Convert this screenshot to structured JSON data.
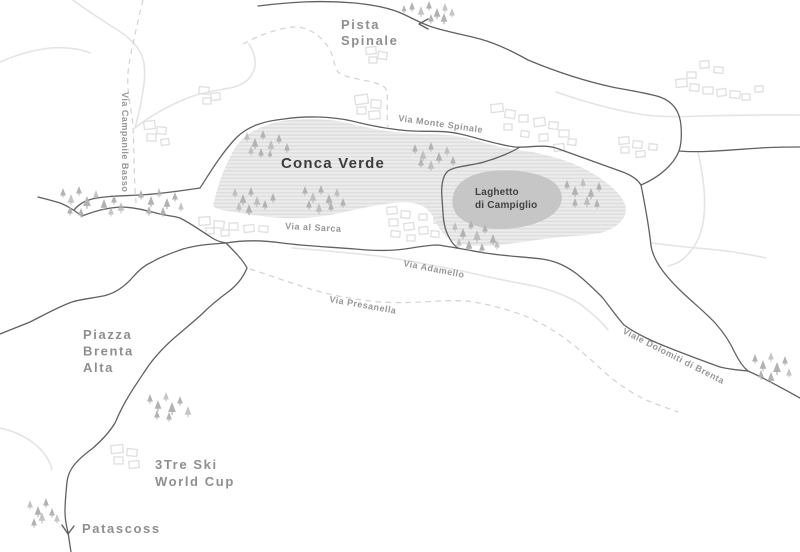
{
  "map": {
    "colors": {
      "background": "#ffffff",
      "road_dark": "#616161",
      "road_light": "#e4e4e4",
      "trail_dashed": "#d2d2d2",
      "terrain_stripe_base": "#ececec",
      "terrain_stripe_line": "#dedede",
      "lake_fill": "#c6c6c6",
      "tree_fill": "#b2b2b2",
      "building_stroke": "#dfdfdf",
      "label_dark": "#3d3d3d",
      "label_gray": "#8f8f8f",
      "label_road": "#979797"
    },
    "labels": [
      {
        "id": "pista-spinale",
        "lines": [
          "Pista",
          "Spinale"
        ],
        "x": 341,
        "y": 29,
        "lh": 16,
        "cls": "place"
      },
      {
        "id": "conca-verde",
        "lines": [
          "Conca Verde"
        ],
        "x": 281,
        "y": 168,
        "cls": "area-major"
      },
      {
        "id": "laghetto-di-campiglio",
        "lines": [
          "Laghetto",
          "di Campiglio"
        ],
        "x": 475,
        "y": 195,
        "lh": 13,
        "cls": "area-minor"
      },
      {
        "id": "via-monte-spinale",
        "lines": [
          "Via Monte Spinale"
        ],
        "x": 398,
        "y": 121,
        "rotate": 8,
        "cls": "road-lbl"
      },
      {
        "id": "via-al-sarca",
        "lines": [
          "Via al Sarca"
        ],
        "x": 285,
        "y": 229,
        "rotate": 3,
        "cls": "road-lbl"
      },
      {
        "id": "via-adamello",
        "lines": [
          "Via Adamello"
        ],
        "x": 403,
        "y": 266,
        "rotate": 11,
        "cls": "road-lbl"
      },
      {
        "id": "via-presanella",
        "lines": [
          "Via Presanella"
        ],
        "x": 329,
        "y": 302,
        "rotate": 10,
        "cls": "road-lbl"
      },
      {
        "id": "viale-dolomiti-di-brenta",
        "lines": [
          "Viale Dolomiti di Brenta"
        ],
        "x": 622,
        "y": 333,
        "rotate": 27,
        "cls": "road-lbl"
      },
      {
        "id": "via-campanile-basso",
        "lines": [
          "Via Campanile Basso"
        ],
        "x": 122,
        "y": 92,
        "rotate": 90,
        "cls": "road-lbl"
      },
      {
        "id": "piazza-brenta-alta",
        "lines": [
          "Piazza",
          "Brenta",
          "Alta"
        ],
        "x": 83,
        "y": 339,
        "lh": 16.5,
        "cls": "place"
      },
      {
        "id": "tre-ski-world-cup",
        "lines": [
          "3Tre Ski",
          "World Cup"
        ],
        "x": 155,
        "y": 469,
        "lh": 17,
        "cls": "place"
      },
      {
        "id": "patascoss",
        "lines": [
          "Patascoss"
        ],
        "x": 82,
        "y": 533,
        "cls": "place"
      }
    ],
    "areas": {
      "conca_verde_terrain": "M 213,206 C 217,187 225,163 237,145 C 247,132 262,125 282,121 C 302,118 328,118 348,123 C 368,128 388,132 408,133 C 428,135 444,133 462,137 C 480,141 500,148 518,150 C 537,152 556,157 574,164 C 591,171 606,181 616,191 C 624,199 628,208 625,215 C 621,224 612,230 600,233 C 585,236 568,236 552,238 C 535,240 518,243 500,245 C 482,247 465,246 455,242 C 445,238 440,230 436,222 C 432,214 428,208 420,205 C 410,201 398,202 386,204 C 370,206 355,210 340,213 C 322,217 302,219 282,218 C 262,217 240,213 228,211 C 220,210 215,208 213,206 Z",
      "lake": "M 453,196 C 456,181 472,173 492,171 C 514,169 538,172 552,181 C 562,188 565,199 558,209 C 549,221 527,228 503,229 C 481,230 461,223 455,212 C 452,206 452,201 453,196 Z"
    },
    "roads_dark": [
      "M 258,6 C 290,2 320,0 355,3 C 375,5 390,8 403,14 C 412,18 420,23 432,27 C 448,32 465,35 480,39 C 495,43 512,51 528,60 C 552,70 580,80 612,87 C 632,91 648,93 660,97 C 674,102 680,112 681,126 C 682,138 681,145 679,151 C 674,164 660,177 641,185",
      "M 679,151 C 700,153 730,150 760,148 C 775,147 788,147 800,147",
      "M 200,188 C 208,176 220,155 236,138 C 248,126 264,121 284,119 C 304,116 330,116 352,121 C 372,126 392,130 412,131 C 430,132 444,130 460,134 C 478,138 498,145 515,147 C 528,148 542,144 556,148 C 576,155 598,163 620,171 C 632,175 638,180 641,185",
      "M 200,188 C 180,191 160,194 140,195 C 122,196 105,196 92,199 C 84,201 78,205 74,210",
      "M 38,197 C 46,199 54,201 60,203 C 68,206 75,211 82,216 C 92,212 105,208 120,207 C 134,207 148,211 160,214 C 168,216 174,216 180,218 C 192,224 204,233 214,239 C 219,242 222,242 226,243",
      "M 520,147 C 512,152 498,158 484,162 C 470,166 455,166 448,171 C 442,176 441,188 442,198 C 443,212 443,224 447,233 C 450,240 453,245 458,248",
      "M 226,243 C 244,240 262,240 282,243 C 305,246 330,247 355,249 C 375,251 390,251 405,249 C 418,247 428,245 438,245 C 452,247 468,250 485,253 C 505,256 525,257 542,259 C 556,261 566,266 577,274 C 588,283 595,290 602,297 C 610,307 616,316 624,325 C 638,335 654,342 672,349 C 690,356 706,362 720,367 C 732,370 740,370 748,371 C 764,378 782,388 800,398",
      "M 641,185 C 645,205 649,226 651,246 C 654,263 668,279 684,294 C 697,306 707,314 716,324 C 724,333 730,342 735,353 C 739,361 743,367 748,371",
      "M 226,243 C 234,251 243,260 247,268 C 243,278 236,286 228,292 C 217,300 209,307 202,314 C 191,324 181,332 173,339 C 162,349 153,359 147,368 C 139,380 132,390 127,399 C 122,407 119,414 115,423 C 109,433 101,441 93,448 C 85,454 79,459 75,464 C 70,470 68,475 67,482 C 66,492 65,502 65,511 C 65,518 66,525 68,532 C 69,539 70,546 71,552",
      "M 0,334 C 10,330 20,326 30,322 C 44,315 58,307 72,302 C 85,298 97,298 107,295 C 117,292 126,285 133,277 C 139,270 145,265 152,262 C 162,256 172,253 183,249 C 197,245 211,244 226,243"
    ],
    "roads_light": [
      "M 292,248 C 320,250 350,253 378,256 C 406,260 436,266 462,271 C 488,277 512,282 534,286 C 552,290 567,296 580,304 C 592,313 601,321 608,330",
      "M 73,0 C 86,10 102,20 116,29 C 129,37 138,46 142,56 C 146,66 145,82 142,96 C 140,110 137,120 135,128",
      "M 135,128 C 150,116 170,105 190,97 C 207,91 222,90 234,87 C 245,84 251,78 254,70 C 257,62 254,52 249,44",
      "M 0,62 C 16,55 33,50 50,48 C 65,47 78,48 90,53",
      "M 556,92 C 582,101 612,110 645,115 C 662,117 682,117 702,116 C 733,115 766,115 800,115",
      "M 698,152 C 703,174 706,196 704,216 C 702,233 697,244 689,253 C 684,260 676,264 668,266",
      "M 652,243 C 674,246 696,248 718,250 C 736,252 752,255 766,258",
      "M 0,428 C 14,431 27,437 37,446 C 45,453 50,461 52,470"
    ],
    "trails_dashed": [
      "M 143,0 C 140,12 136,30 132,48 C 129,64 127,72 128,88 C 129,102 132,112 133,128 C 134,150 134,170 135,188 C 135,194 136,199 136,203",
      "M 243,44 C 258,36 275,29 293,27 C 308,26 322,36 330,50 C 334,58 334,66 338,72 C 346,78 360,79 372,82 C 380,84 386,86 387,92 C 388,102 386,114 388,127",
      "M 250,269 C 266,274 282,280 298,285 C 318,292 340,297 362,300 C 382,303 402,303 422,302 C 438,301 452,300 466,301 C 484,303 502,308 520,314 C 536,320 550,328 563,337 C 577,347 589,358 601,369 C 614,381 628,391 644,399 C 655,404 667,408 678,412"
    ],
    "markers": [
      {
        "id": "road-arrow-top",
        "d": "M 428,19 L 419,24 L 428,29"
      },
      {
        "id": "patascoss-arrow",
        "d": "M 62,525 L 68,534 L 74,526"
      }
    ],
    "trees": [
      [
        412,
        2,
        6
      ],
      [
        421,
        6,
        7
      ],
      [
        429,
        1,
        6
      ],
      [
        437,
        8,
        7
      ],
      [
        445,
        3,
        6
      ],
      [
        431,
        14,
        6
      ],
      [
        444,
        13,
        7
      ],
      [
        452,
        8,
        6
      ],
      [
        404,
        5,
        5
      ],
      [
        63,
        188,
        6
      ],
      [
        71,
        194,
        7
      ],
      [
        79,
        186,
        6
      ],
      [
        87,
        196,
        8
      ],
      [
        96,
        190,
        6
      ],
      [
        104,
        199,
        7
      ],
      [
        114,
        195,
        6
      ],
      [
        121,
        202,
        7
      ],
      [
        70,
        206,
        6
      ],
      [
        81,
        208,
        6
      ],
      [
        111,
        207,
        6
      ],
      [
        141,
        190,
        6
      ],
      [
        151,
        196,
        7
      ],
      [
        159,
        188,
        6
      ],
      [
        167,
        198,
        7
      ],
      [
        175,
        192,
        6
      ],
      [
        181,
        202,
        6
      ],
      [
        149,
        206,
        6
      ],
      [
        163,
        207,
        6
      ],
      [
        247,
        132,
        6
      ],
      [
        255,
        138,
        7
      ],
      [
        263,
        130,
        6
      ],
      [
        271,
        140,
        7
      ],
      [
        279,
        134,
        6
      ],
      [
        287,
        143,
        6
      ],
      [
        251,
        146,
        6
      ],
      [
        261,
        148,
        6
      ],
      [
        270,
        150,
        5
      ],
      [
        235,
        188,
        6
      ],
      [
        243,
        194,
        7
      ],
      [
        251,
        187,
        6
      ],
      [
        257,
        196,
        7
      ],
      [
        265,
        200,
        6
      ],
      [
        273,
        193,
        6
      ],
      [
        239,
        202,
        6
      ],
      [
        249,
        204,
        7
      ],
      [
        305,
        186,
        6
      ],
      [
        313,
        192,
        7
      ],
      [
        321,
        185,
        6
      ],
      [
        329,
        194,
        7
      ],
      [
        337,
        188,
        6
      ],
      [
        343,
        198,
        6
      ],
      [
        309,
        200,
        6
      ],
      [
        319,
        203,
        7
      ],
      [
        331,
        202,
        6
      ],
      [
        415,
        144,
        6
      ],
      [
        423,
        150,
        7
      ],
      [
        431,
        142,
        6
      ],
      [
        439,
        152,
        7
      ],
      [
        447,
        146,
        6
      ],
      [
        453,
        156,
        6
      ],
      [
        421,
        158,
        6
      ],
      [
        431,
        160,
        7
      ],
      [
        567,
        180,
        6
      ],
      [
        575,
        186,
        7
      ],
      [
        583,
        178,
        6
      ],
      [
        591,
        188,
        7
      ],
      [
        599,
        182,
        6
      ],
      [
        587,
        196,
        7
      ],
      [
        575,
        198,
        6
      ],
      [
        597,
        199,
        6
      ],
      [
        455,
        222,
        6
      ],
      [
        463,
        228,
        7
      ],
      [
        471,
        220,
        6
      ],
      [
        477,
        230,
        8
      ],
      [
        485,
        224,
        6
      ],
      [
        493,
        234,
        7
      ],
      [
        459,
        238,
        6
      ],
      [
        469,
        240,
        7
      ],
      [
        482,
        243,
        6
      ],
      [
        497,
        240,
        6
      ],
      [
        150,
        394,
        6
      ],
      [
        158,
        400,
        7
      ],
      [
        166,
        392,
        6
      ],
      [
        172,
        402,
        8
      ],
      [
        180,
        396,
        6
      ],
      [
        188,
        406,
        7
      ],
      [
        157,
        410,
        6
      ],
      [
        169,
        412,
        6
      ],
      [
        30,
        500,
        6
      ],
      [
        38,
        506,
        7
      ],
      [
        46,
        498,
        6
      ],
      [
        42,
        512,
        7
      ],
      [
        52,
        508,
        6
      ],
      [
        34,
        518,
        6
      ],
      [
        57,
        514,
        6
      ],
      [
        755,
        354,
        6
      ],
      [
        763,
        360,
        7
      ],
      [
        771,
        352,
        6
      ],
      [
        777,
        362,
        8
      ],
      [
        785,
        356,
        6
      ],
      [
        789,
        368,
        6
      ],
      [
        761,
        370,
        6
      ],
      [
        771,
        372,
        7
      ]
    ],
    "buildings": [
      [
        355,
        95,
        13,
        9,
        -8
      ],
      [
        371,
        100,
        10,
        8,
        6
      ],
      [
        357,
        107,
        9,
        7,
        0
      ],
      [
        369,
        111,
        11,
        8,
        -5
      ],
      [
        366,
        47,
        10,
        7,
        -6
      ],
      [
        378,
        52,
        9,
        7,
        8
      ],
      [
        369,
        57,
        8,
        6,
        0
      ],
      [
        491,
        104,
        12,
        8,
        -6
      ],
      [
        505,
        110,
        10,
        8,
        10
      ],
      [
        519,
        115,
        9,
        7,
        0
      ],
      [
        534,
        118,
        11,
        8,
        -8
      ],
      [
        549,
        122,
        9,
        7,
        6
      ],
      [
        559,
        130,
        10,
        7,
        0
      ],
      [
        539,
        134,
        9,
        7,
        -6
      ],
      [
        521,
        131,
        8,
        6,
        8
      ],
      [
        504,
        124,
        8,
        6,
        0
      ],
      [
        554,
        144,
        10,
        7,
        -6
      ],
      [
        568,
        139,
        8,
        6,
        6
      ],
      [
        700,
        61,
        9,
        7,
        -6
      ],
      [
        714,
        67,
        9,
        6,
        6
      ],
      [
        676,
        79,
        11,
        8,
        -5
      ],
      [
        690,
        84,
        9,
        7,
        6
      ],
      [
        703,
        87,
        10,
        7,
        0
      ],
      [
        717,
        89,
        9,
        7,
        -8
      ],
      [
        730,
        91,
        10,
        7,
        6
      ],
      [
        742,
        94,
        8,
        6,
        0
      ],
      [
        687,
        72,
        9,
        6,
        0
      ],
      [
        755,
        86,
        8,
        6,
        -5
      ],
      [
        144,
        121,
        11,
        8,
        -6
      ],
      [
        157,
        127,
        9,
        7,
        6
      ],
      [
        147,
        134,
        9,
        7,
        0
      ],
      [
        161,
        139,
        8,
        6,
        -8
      ],
      [
        199,
        87,
        10,
        7,
        6
      ],
      [
        211,
        93,
        9,
        7,
        -6
      ],
      [
        203,
        98,
        8,
        6,
        0
      ],
      [
        199,
        217,
        11,
        8,
        -5
      ],
      [
        214,
        221,
        10,
        7,
        6
      ],
      [
        229,
        223,
        9,
        7,
        0
      ],
      [
        244,
        225,
        10,
        7,
        -6
      ],
      [
        259,
        226,
        9,
        6,
        6
      ],
      [
        206,
        228,
        8,
        6,
        0
      ],
      [
        221,
        230,
        8,
        6,
        -6
      ],
      [
        387,
        207,
        10,
        7,
        -6
      ],
      [
        401,
        211,
        9,
        7,
        6
      ],
      [
        389,
        219,
        9,
        7,
        0
      ],
      [
        404,
        223,
        10,
        7,
        -8
      ],
      [
        391,
        231,
        9,
        6,
        6
      ],
      [
        407,
        235,
        8,
        6,
        0
      ],
      [
        419,
        227,
        9,
        7,
        -6
      ],
      [
        431,
        231,
        8,
        6,
        6
      ],
      [
        419,
        214,
        8,
        6,
        0
      ],
      [
        434,
        217,
        9,
        6,
        -6
      ],
      [
        619,
        137,
        10,
        7,
        -6
      ],
      [
        633,
        141,
        9,
        7,
        6
      ],
      [
        621,
        147,
        8,
        6,
        0
      ],
      [
        636,
        151,
        9,
        6,
        -6
      ],
      [
        649,
        144,
        8,
        6,
        6
      ],
      [
        111,
        445,
        12,
        8,
        -6
      ],
      [
        127,
        449,
        10,
        7,
        6
      ],
      [
        114,
        457,
        9,
        7,
        0
      ],
      [
        129,
        461,
        10,
        7,
        -6
      ]
    ]
  }
}
